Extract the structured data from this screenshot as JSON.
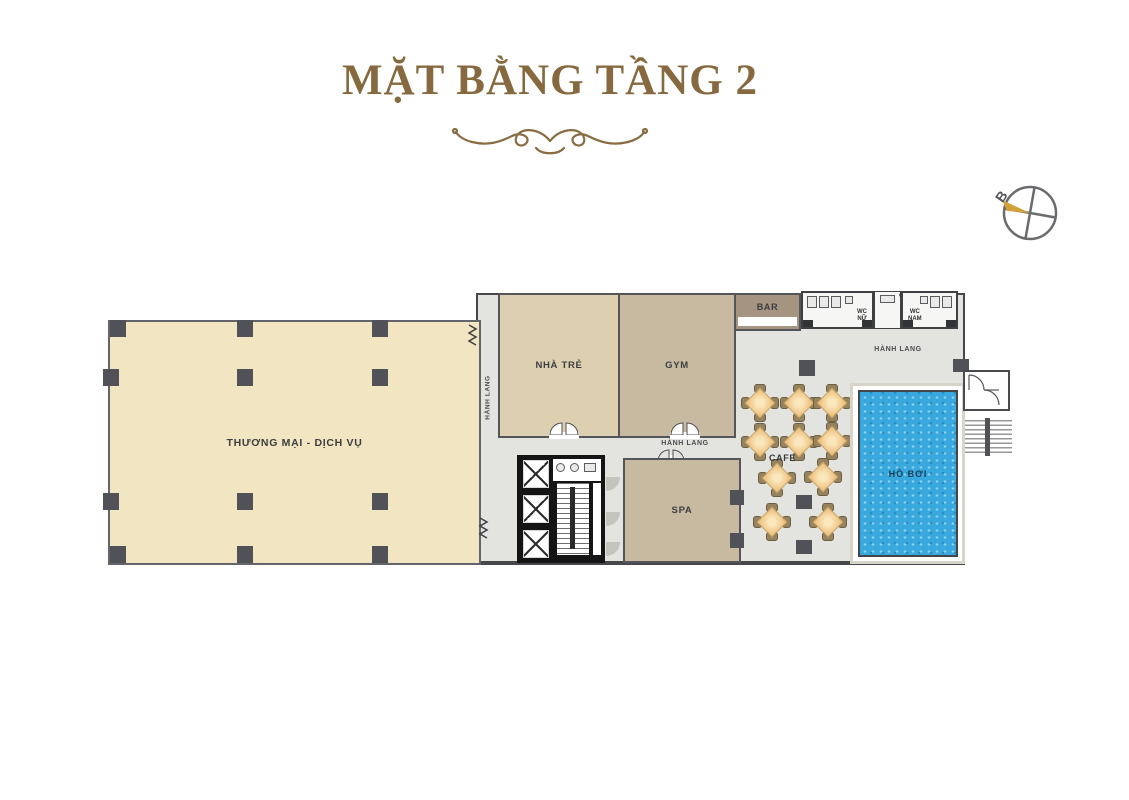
{
  "page": {
    "title": "MẶT BẰNG TẦNG 2"
  },
  "compass": {
    "north_label": "B"
  },
  "plan": {
    "labels": {
      "thuong_mai": "THƯƠNG MẠI - DỊCH VỤ",
      "hanh_lang": "HÀNH LANG",
      "nha_tre": "NHÀ TRẺ",
      "gym": "GYM",
      "bar": "BAR",
      "wc": "WC",
      "wc_nu": "NỮ",
      "wc_nam": "NAM",
      "o_kt": "Ô KT",
      "spa": "SPA",
      "cafe": "CAFE",
      "ho_boi": "HỒ BƠI"
    },
    "colors": {
      "title_brown": "#86693f",
      "room_cream": "#f2e5c1",
      "room_tan": "#ddd0b0",
      "room_taupe": "#c8baa0",
      "bar_brown": "#a59580",
      "corridor_gray": "#e3e3df",
      "column_gray": "#515257",
      "pool_blue": "#38a9de",
      "table_peach": "#efc685",
      "chair_brown": "#95825f",
      "compass_gold": "#d2a13a"
    }
  }
}
